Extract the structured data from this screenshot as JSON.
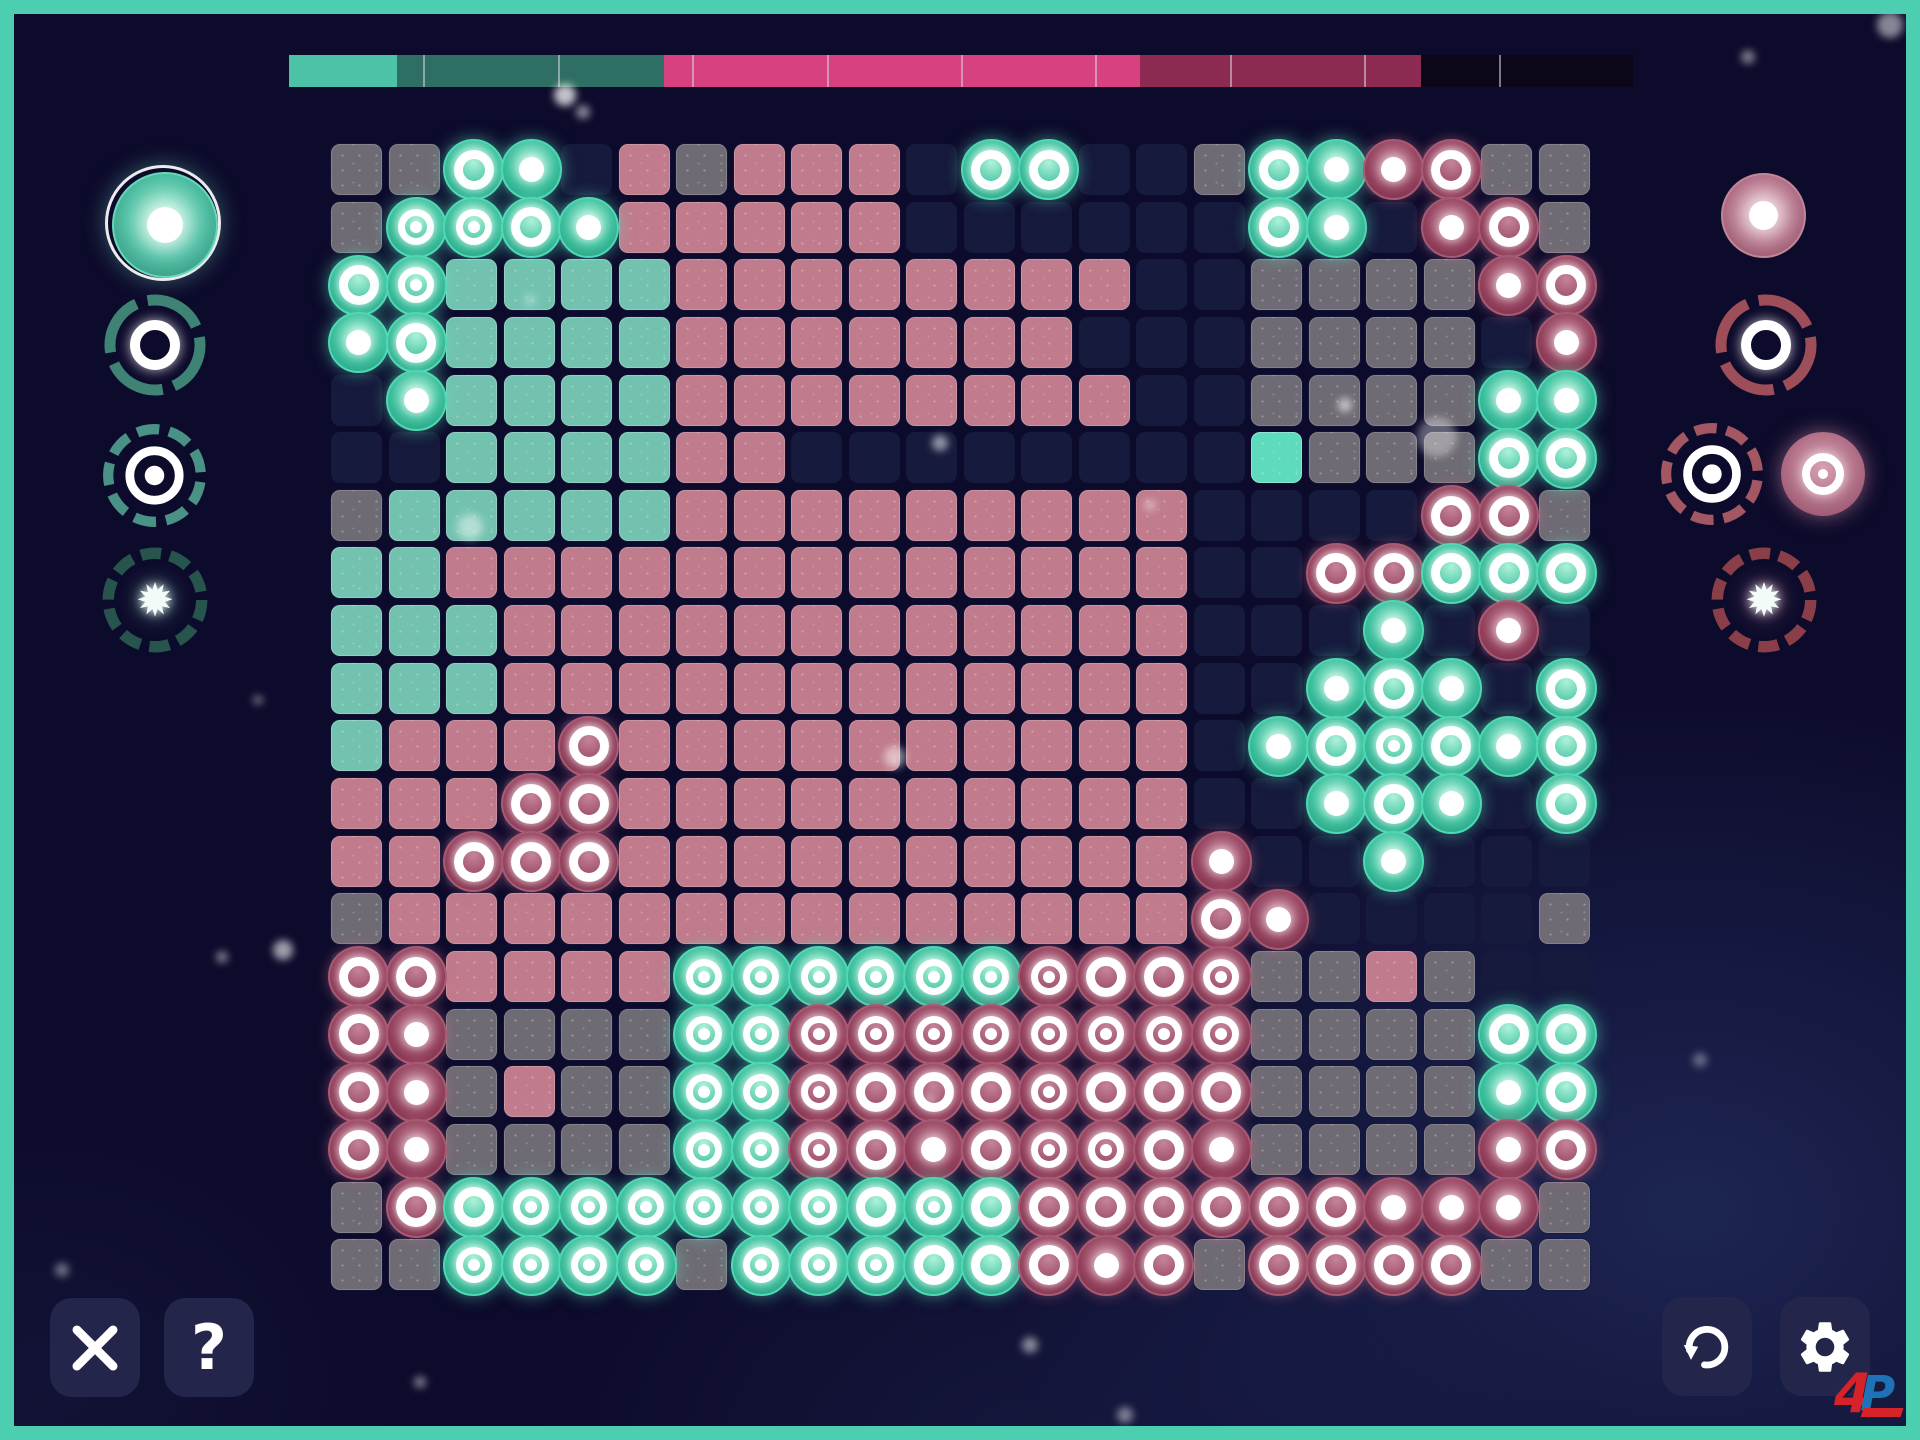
{
  "hud": {
    "progress_bar": {
      "divisions": 10,
      "segments": [
        {
          "name": "teal-filled",
          "color": "#4cc2a7",
          "percent": 8.0
        },
        {
          "name": "teal-dim",
          "color": "#2f6e62",
          "percent": 19.9
        },
        {
          "name": "pink-filled",
          "color": "#d8417f",
          "percent": 35.4
        },
        {
          "name": "pink-dim",
          "color": "#8c2a52",
          "percent": 20.9
        },
        {
          "name": "unclaimed-black",
          "color": "#0b0719",
          "percent": 15.8
        }
      ]
    }
  },
  "palettes": {
    "left": {
      "side": "teal",
      "accent": "#4fd0b3",
      "dash_colors": {
        "ring": "#3f8375",
        "target": "#45postponed",
        "burst": "#27544d"
      },
      "items": [
        {
          "name": "dot-brush",
          "type": "dot",
          "selected": true,
          "glyph": ""
        },
        {
          "name": "ring-brush",
          "type": "ring",
          "selected": false,
          "glyph": ""
        },
        {
          "name": "target-brush",
          "type": "target",
          "selected": false,
          "glyph": ""
        },
        {
          "name": "burst-brush",
          "type": "burst",
          "selected": false,
          "glyph": "✹"
        }
      ]
    },
    "right": {
      "side": "pink",
      "accent": "#c2607c",
      "items": [
        {
          "name": "dot-brush",
          "type": "dot",
          "selected": false,
          "glyph": ""
        },
        {
          "name": "ring-brush",
          "type": "ring",
          "selected": false,
          "glyph": ""
        },
        {
          "name": "target-brush",
          "type": "target",
          "selected": true,
          "glyph": ""
        },
        {
          "name": "burst-brush",
          "type": "burst",
          "selected": false,
          "glyph": "✹"
        }
      ]
    }
  },
  "board": {
    "columns": 22,
    "rows": 20,
    "cell_legend": {
      "_": "empty",
      "T": "teal-cell",
      "Tb": "bright-teal-cell",
      "P": "pink-cell",
      "G": "gray-cell",
      "tr": "teal-ring-token",
      "td": "teal-dot-token",
      "tt": "teal-target-token",
      "pr": "pink-ring-token",
      "pd": "pink-dot-token",
      "pt": "pink-target-token"
    },
    "cells": [
      "G G tr td _ P G P P P _ tr tr _ _ G tr td pd pr G G",
      "G tt tt tr td P P P P P _ _ _ _ _ _ tr td _ pd pr G",
      "tr tt T T T T P P P P P P P P _ _ G G G G pd pr",
      "td tr T T T T P P P P P P P _ _ _ G G G G _ pd",
      "_ td T T T T P P P P P P P P _ _ G G G G td td",
      "_ _ T T T T P P _ _ _ _ _ _ _ _ Tb G G G tr tr",
      "G T T T T T P P P P P P P P P _ _ _ _ pr pr G",
      "T T P P P P P P P P P P P P P _ _ pr pr tr tr tr",
      "T T T P P P P P P P P P P P P _ _ _ td _ pd _",
      "T T T P P P P P P P P P P P P _ _ td tr td _ tr",
      "T P P P pr P P P P P P P P P P _ td tr tt tr td tr",
      "P P P pr pr P P P P P P P P P P _ _ td tr td _ tr",
      "P P pr pr pr P P P P P P P P P P pd _ _ td _ _ _",
      "G P P P P P P P P P P P P P P pr pd _ _ _ _ G",
      "pr pr P P P P tt tt tt tt tt tt pt pr pr pt G G P G _ _",
      "pr pd G G G G tt tt pt pt pt pt pt pt pt pt G G G G tr tr",
      "pr pd G P G G tt tt pt pr pr pr pt pr pr pr G G G G td tr",
      "pr pd G G G G tt tt pt pr pd pr pt pt pr pd G G G G pd pr",
      "G pr tr tt tt tt tt tt tt tr tt tr pr pr pr pr pr pr pd pd pd G",
      "G G tt tt tt tt G tt tt tt tr tr pr pd pr G pr pr pr pr G G"
    ]
  },
  "buttons": {
    "close_label": "✕",
    "help_label": "?",
    "undo": "undo-icon",
    "settings": "settings-icon"
  },
  "watermark": {
    "letters": [
      "4",
      "P"
    ],
    "colors": {
      "four": "#d6232a",
      "p": "#1e72b8"
    }
  }
}
